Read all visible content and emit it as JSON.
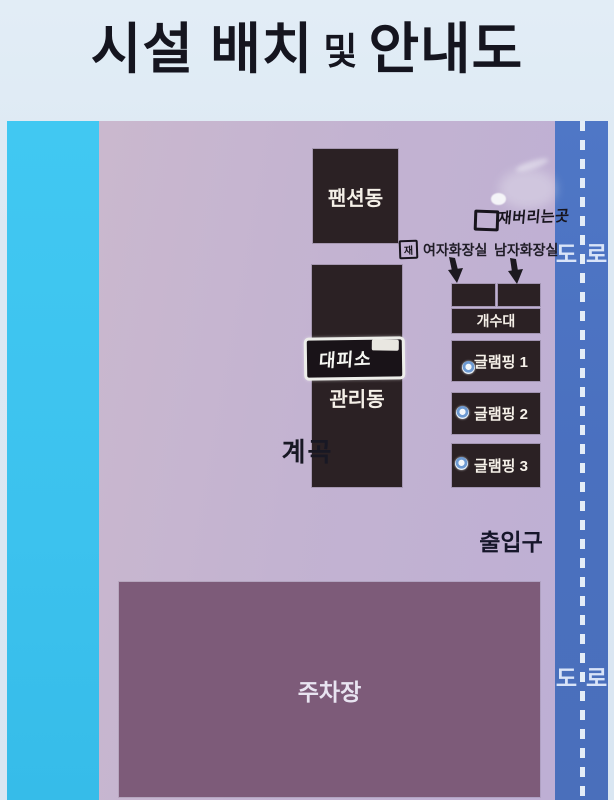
{
  "title": {
    "seg1": "시설 배치",
    "seg2": "및",
    "seg3": "안내도"
  },
  "map": {
    "valley_label": "계곡",
    "road_label": "도로",
    "pension_label": "팬션동",
    "management_label": "관리동",
    "shelter_sign_label": "대피소",
    "ash_marker": "재",
    "ash_disposal_label": "재버리는곳",
    "women_restroom_label": "여자화장실",
    "men_restroom_label": "남자화장실",
    "sink_label": "개수대",
    "glamping": [
      {
        "label": "글램핑 1"
      },
      {
        "label": "글램핑 2"
      },
      {
        "label": "글램핑 3"
      }
    ],
    "entrance_label": "출입구",
    "parking_label": "주차장"
  },
  "colors": {
    "sign_background": "#dce8f3",
    "valley_cyan": "#3cc2ee",
    "grounds_purple": "#c3b3d1",
    "road_blue": "#4a70bf",
    "road_dash_white": "#e4edf7",
    "building_dark": "#2b2124",
    "parking_mauve": "#7d5b79",
    "text_dark": "#16162a",
    "text_light": "#f5f0e8"
  }
}
